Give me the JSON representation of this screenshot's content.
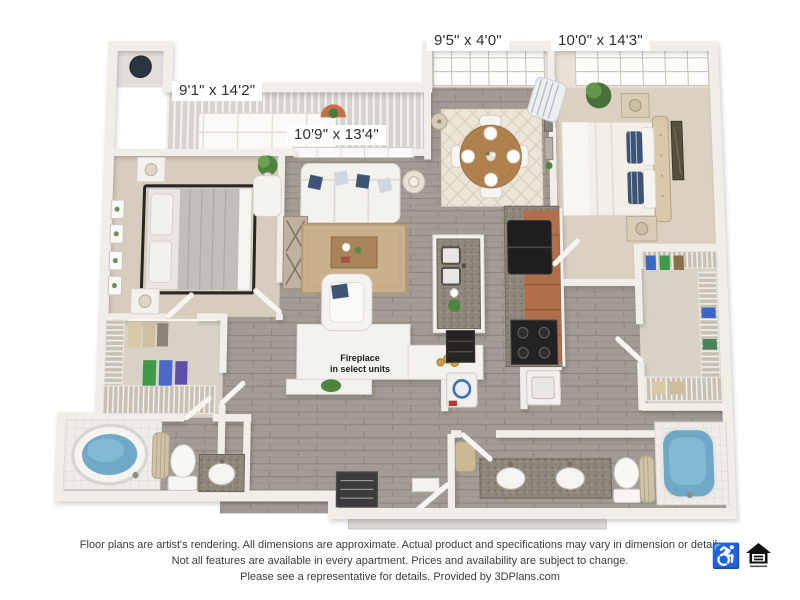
{
  "plan": {
    "labels": {
      "bedroom1": "9'1\" x 14'2\"",
      "living_room": "10'9\" x 13'4\"",
      "sunroom": "9'5\" x 4'0\"",
      "bedroom2": "10'0\" x 14'3\""
    },
    "fireplace_note_line1": "Fireplace",
    "fireplace_note_line2": "in select units"
  },
  "footer": {
    "disclaimer_line1": "Floor plans are artist's rendering. All dimensions are approximate. Actual product and specifications may vary in dimension or detail.",
    "disclaimer_line2": "Not all features are available in every apartment. Prices and availability are subject to change.",
    "disclaimer_line3": "Please see a representative for details. Provided by 3DPlans.com",
    "accessibility_icon": "wheelchair-accessible",
    "equal_housing_icon": "equal-housing-opportunity",
    "wheelchair_glyph": "♿"
  },
  "colors": {
    "wood_floor": "#a29c94",
    "carpet": "#d7cdbd",
    "wall": "#f1eee9",
    "cabinet_terracotta": "#b06f4b",
    "granite": "#8e877b",
    "tub_water": "#6fa9c6",
    "accent_pillow_navy": "#3d5475",
    "dining_table_wood": "#b0814f",
    "plant_green": "#4e8340",
    "label_text": "#2e2e2e",
    "disclaimer_text": "#3a3a3a"
  }
}
